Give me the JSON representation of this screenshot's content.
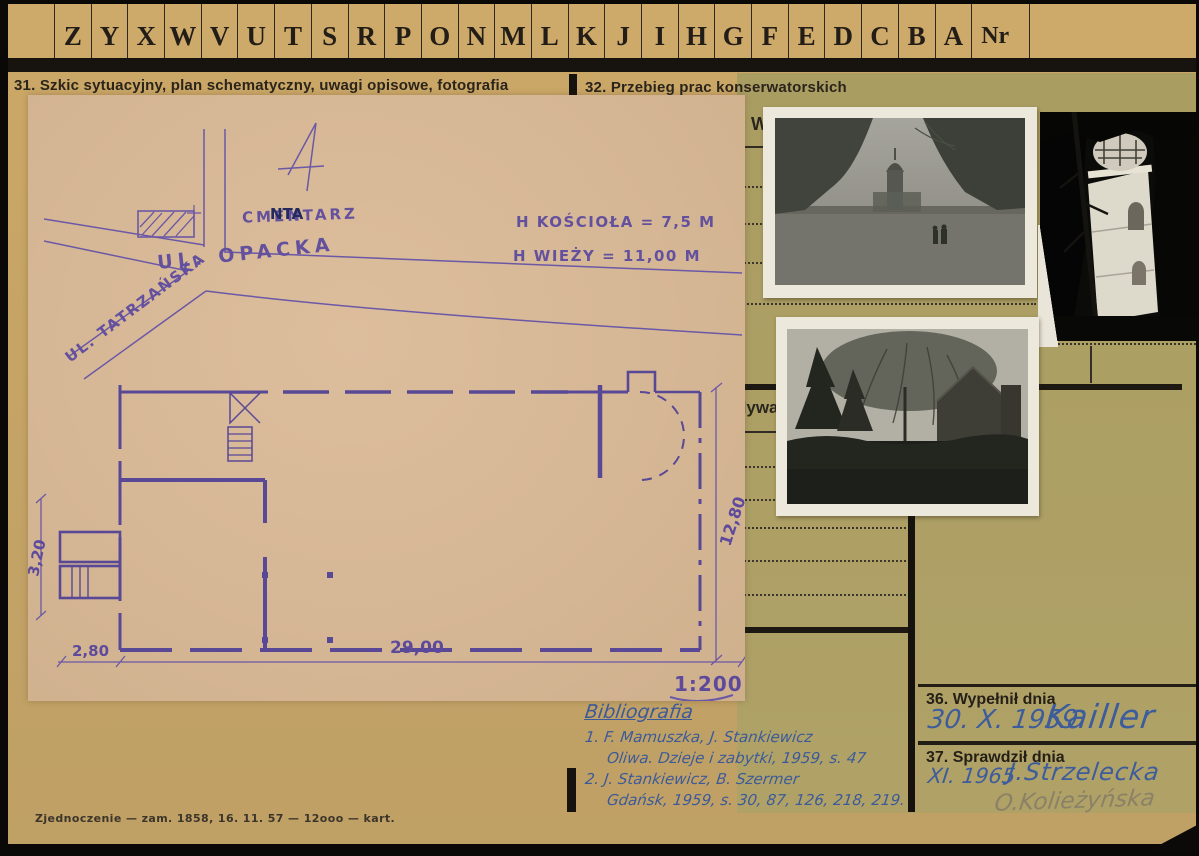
{
  "tabs": {
    "letters": [
      "Z",
      "Y",
      "X",
      "W",
      "V",
      "U",
      "T",
      "S",
      "R",
      "P",
      "O",
      "N",
      "M",
      "L",
      "K",
      "J",
      "I",
      "H",
      "G",
      "F",
      "E",
      "D",
      "C",
      "B",
      "A"
    ],
    "nr": "Nr"
  },
  "section31": {
    "title": "31. Szkic sytuacyjny, plan schematyczny, uwagi opisowe, fotografia"
  },
  "section32": {
    "title": "32. Przebieg prac konserwatorskich",
    "partial_text_top": "W",
    "partial_text_mid": "dywa"
  },
  "sketch": {
    "map": {
      "cemetery": "CMENTARZ",
      "cemetery_stamp": "NTA",
      "street_opacka": "UL. OPACKA",
      "street_tatrzanska": "UL. TATRZAŃSKA"
    },
    "heights": {
      "church": "H KOŚCIOŁA = 7,5 M",
      "tower": "H WIEŻY = 11,00 M"
    },
    "plan": {
      "dim_bottom_main": "29,00",
      "dim_bottom_annex": "2,80",
      "dim_right": "12,80",
      "dim_left": "3,20",
      "scale": "1:200"
    }
  },
  "bibliography": {
    "title": "Bibliografia",
    "entries": [
      "1. F. Mamuszka, J. Stankiewicz",
      "Oliwa. Dzieje i zabytki, 1959, s. 47",
      "2. J. Stankiewicz, B. Szermer",
      "Gdańsk, 1959, s. 30, 87, 126, 218, 219."
    ]
  },
  "box36": {
    "title": "36. Wypełnił dnia",
    "date": "30. X. 1959",
    "signature": "Kailler"
  },
  "box37": {
    "title": "37. Sprawdził dnia",
    "date": "XI. 1965",
    "signature": "J.Strzelecka",
    "pencil_signature": "O.Kolieżyńska"
  },
  "footer": {
    "imprint": "Zjednoczenie — zam. 1858, 16. 11. 57 — 12ooo — kart."
  },
  "colors": {
    "card": "#c6a466",
    "card_right_column": "#aa9d62",
    "sketch_paper": "#d6b795",
    "plan_ink_violet": "#584896",
    "handwriting_blue": "#3d5c9c",
    "pencil": "#8a8167",
    "print_black": "#17140f"
  }
}
